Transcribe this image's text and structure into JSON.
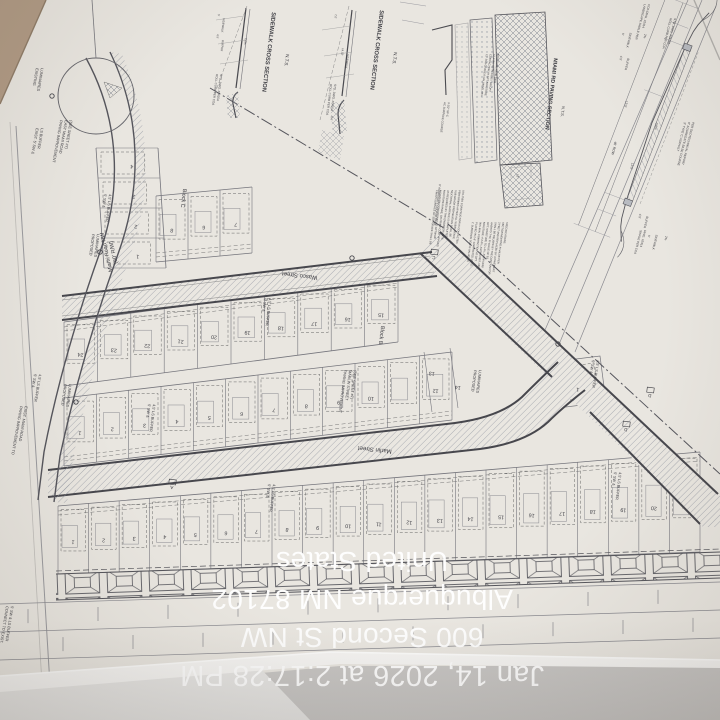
{
  "overlay": {
    "lines": [
      "Jan 14, 2026 at 2:17:28 PM",
      "600 Second St NW",
      "Albuquerque NM 87102",
      "United States"
    ],
    "color": "#ffffff"
  },
  "palette": {
    "paper": "#eae7e1",
    "table": "#b19b85",
    "ink": "#3c3c42",
    "curb": "#46464c",
    "thin": "#75757c",
    "hatch": "#9095a0",
    "shadow": "#c8c6c4",
    "fold": "#f7f6f4"
  },
  "plan": {
    "streets": [
      {
        "label": "Miami Road NW",
        "sub": "(60' R/W)"
      },
      {
        "label": "Wasco Street"
      },
      {
        "label": "Marlin Street"
      }
    ],
    "blocks": [
      {
        "name": "Block B"
      },
      {
        "name": "Block C"
      }
    ],
    "details": [
      {
        "title": "SIDEWALK CROSS SECTION",
        "scale": "N.T.S."
      },
      {
        "title": "SIDEWALK CROSS SECTION",
        "scale": "N.T.S."
      },
      {
        "title": "MIAMI RD PAVING SECTION",
        "scale": "N.T.S."
      }
    ],
    "bands": [
      {
        "name": "block-b-north-row",
        "x0": 64,
        "t0": 322,
        "b0": 386,
        "x1": 398,
        "t1": 278,
        "b1": 342,
        "f": "t",
        "nums": [
          "24",
          "23",
          "22",
          "21",
          "20",
          "19",
          "18",
          "17",
          "16",
          "15"
        ]
      },
      {
        "name": "block-b-south-row",
        "x0": 64,
        "t0": 398,
        "b0": 466,
        "x1": 452,
        "t1": 352,
        "b1": 420,
        "f": "b",
        "nums": [
          "1",
          "2",
          "3",
          "4",
          "5",
          "6",
          "7",
          "8",
          "9",
          "10",
          "",
          "12"
        ]
      },
      {
        "name": "block-a-row",
        "x0": 58,
        "t0": 506,
        "b0": 574,
        "x1": 700,
        "t1": 452,
        "b1": 552,
        "f": "t",
        "nums": [
          "1",
          "2",
          "3",
          "4",
          "5",
          "6",
          "7",
          "8",
          "9",
          "10",
          "11",
          "12",
          "13",
          "14",
          "15",
          "16",
          "17",
          "18",
          "19",
          "20",
          "21"
        ]
      },
      {
        "name": "block-c-wasco-row",
        "x0": 156,
        "t0": 196,
        "b0": 262,
        "x1": 252,
        "t1": 187,
        "b1": 253,
        "f": "b",
        "nums": [
          "8",
          "6",
          "7"
        ]
      },
      {
        "name": "block-c-miami-column",
        "col": true,
        "y0": 148,
        "l0": 96,
        "r0": 158,
        "y1": 268,
        "l1": 104,
        "r1": 166,
        "nums": [
          "4",
          "3",
          "2",
          "1"
        ]
      }
    ],
    "labels": [
      {
        "id": "label-street-miami",
        "x": 108,
        "y": 252,
        "r": 257,
        "s": 5.5,
        "a": "middle",
        "dx": 7,
        "L": [
          "Miami Road NW",
          "(60' R/W)"
        ]
      },
      {
        "id": "label-street-wasco",
        "x": 300,
        "y": 274,
        "r": 187,
        "s": 6,
        "a": "middle",
        "L": [
          "Wasco Street"
        ]
      },
      {
        "id": "label-street-marlin",
        "x": 375,
        "y": 448,
        "r": 186,
        "s": 6,
        "a": "middle",
        "L": [
          "Marlin Street"
        ]
      },
      {
        "id": "label-block-b",
        "x": 380,
        "y": 335,
        "r": 97,
        "s": 5.5,
        "a": "middle",
        "L": [
          "Block B"
        ]
      },
      {
        "id": "label-block-c",
        "x": 182,
        "y": 198,
        "r": 97,
        "s": 5.5,
        "a": "middle",
        "L": [
          "Block C"
        ]
      },
      {
        "id": "label-buffer-1",
        "x": 148,
        "y": 404,
        "r": 97,
        "s": 3.8,
        "dx": 5,
        "L": [
          "5' SW &",
          "4.5' LS BUFFER"
        ]
      },
      {
        "id": "label-buffer-2",
        "x": 264,
        "y": 298,
        "r": 97,
        "s": 3.8,
        "dx": 5,
        "L": [
          "5' SW &",
          "4.5' LS BUFFER"
        ]
      },
      {
        "id": "label-buffer-3",
        "x": 104,
        "y": 194,
        "r": 97,
        "s": 3.8,
        "dx": 5,
        "L": [
          "5' SW &",
          "4.5' LS BUFFER"
        ]
      },
      {
        "id": "label-buffer-4",
        "x": 268,
        "y": 484,
        "r": 97,
        "s": 3.8,
        "dx": 5,
        "L": [
          "5' SW &",
          "4.5' LS BUFFER"
        ]
      },
      {
        "id": "label-buffer-5",
        "x": 614,
        "y": 472,
        "r": 97,
        "s": 3.8,
        "dx": 5,
        "L": [
          "5' SW &",
          "4.5' LS BUFFER"
        ]
      },
      {
        "id": "label-buffer-6",
        "x": 592,
        "y": 360,
        "r": 100,
        "s": 3.8,
        "dx": 5,
        "L": [
          "5' SW &",
          "4.5' LS BUFFER"
        ]
      },
      {
        "id": "label-buffer-7",
        "x": 34,
        "y": 374,
        "r": 100,
        "s": 3.8,
        "dx": 5,
        "L": [
          "5' SW &",
          "4.5' LS BUFFER"
        ]
      },
      {
        "id": "label-buffer-exist",
        "x": 36,
        "y": 128,
        "r": 100,
        "s": 3.8,
        "dx": 5,
        "L": [
          "EXIST. 5' SW &",
          "LS BUFFER"
        ]
      },
      {
        "id": "note-paving-marlin",
        "x": 344,
        "y": 370,
        "r": 97,
        "s": 3.8,
        "dx": 5,
        "L": [
          "PAVING IMPROVEMENT",
          "MARLIN STREET",
          "(SEE SHEET #7)"
        ]
      },
      {
        "id": "note-paving-miami",
        "x": 20,
        "y": 406,
        "r": 100,
        "s": 3.8,
        "dx": 5,
        "L": [
          "PAVING IMPROVEMENT TO",
          "EXIST. MIAMI ROAD"
        ]
      },
      {
        "id": "note-paving-east-miami",
        "x": 60,
        "y": 120,
        "r": 100,
        "s": 3.8,
        "dx": 5,
        "L": [
          "PAVING IMPROVEMENT",
          "EAST MIAMI ROAD",
          "(SEE SHEET #7)"
        ]
      },
      {
        "id": "note-connect-exist",
        "x": 6,
        "y": 606,
        "r": 99,
        "s": 3.8,
        "dx": 5,
        "L": [
          "CONNECT TO EXIST.",
          "5' SW & LS BUFFER"
        ]
      },
      {
        "id": "note-proposed-luminaires-1",
        "x": 92,
        "y": 234,
        "r": 97,
        "s": 3.8,
        "dx": 5,
        "L": [
          "PROPOSED",
          "LUMINAIRES"
        ]
      },
      {
        "id": "note-proposed-luminaires-2",
        "x": 64,
        "y": 384,
        "r": 97,
        "s": 3.8,
        "dx": 5,
        "L": [
          "PROPOSED",
          "LUMINAIRES"
        ]
      },
      {
        "id": "note-proposed-luminaires-3",
        "x": 474,
        "y": 370,
        "r": 97,
        "s": 3.8,
        "dx": 5,
        "L": [
          "PROPOSED",
          "LUMINAIRES"
        ]
      },
      {
        "id": "note-existing-luminaires",
        "x": 36,
        "y": 68,
        "r": 100,
        "s": 3.8,
        "dx": 5,
        "L": [
          "EXISTING",
          "LUMINAIRES"
        ]
      },
      {
        "id": "lot-13",
        "x": 432,
        "y": 372,
        "r": 187,
        "s": 5.2,
        "a": "middle",
        "L": [
          "13"
        ]
      },
      {
        "id": "lot-14",
        "x": 458,
        "y": 386,
        "r": 187,
        "s": 5.2,
        "a": "middle",
        "L": [
          "14"
        ]
      },
      {
        "id": "lot-east-1",
        "x": 578,
        "y": 388,
        "r": 187,
        "s": 5.2,
        "a": "middle",
        "L": [
          "1"
        ]
      },
      {
        "id": "section-marker-a",
        "x": 172,
        "y": 486,
        "r": 187,
        "s": 4.6,
        "a": "middle",
        "m": 1,
        "L": [
          "A"
        ]
      },
      {
        "id": "section-marker-c",
        "x": 434,
        "y": 256,
        "r": 187,
        "s": 4.6,
        "a": "middle",
        "m": 1,
        "L": [
          "C"
        ]
      },
      {
        "id": "section-marker-d1",
        "x": 650,
        "y": 394,
        "r": 187,
        "s": 4.6,
        "a": "middle",
        "m": 1,
        "L": [
          "D"
        ]
      },
      {
        "id": "section-marker-d2",
        "x": 626,
        "y": 428,
        "r": 187,
        "s": 4.6,
        "a": "middle",
        "m": 1,
        "L": [
          "D"
        ]
      },
      {
        "id": "detail1-title",
        "x": 272,
        "y": 12,
        "r": 97,
        "s": 5.8,
        "b": 1,
        "L": [
          "SIDEWALK CROSS SECTION"
        ]
      },
      {
        "id": "detail1-scale",
        "x": 286,
        "y": 54,
        "r": 97,
        "s": 4.6,
        "L": [
          "N.T.S."
        ]
      },
      {
        "id": "detail2-title",
        "x": 380,
        "y": 10,
        "r": 97,
        "s": 5.8,
        "b": 1,
        "L": [
          "SIDEWALK CROSS SECTION"
        ]
      },
      {
        "id": "detail2-scale",
        "x": 394,
        "y": 52,
        "r": 97,
        "s": 4.6,
        "L": [
          "N.T.S."
        ]
      },
      {
        "id": "detail3-title",
        "x": 554,
        "y": 58,
        "r": 97,
        "s": 5.4,
        "b": 1,
        "L": [
          "MIAMI RD PAVING SECTION"
        ]
      },
      {
        "id": "detail3-scale",
        "x": 562,
        "y": 106,
        "r": 97,
        "s": 4,
        "L": [
          "N.T.S."
        ]
      },
      {
        "id": "note-roll-curb-1",
        "x": 216,
        "y": 74,
        "r": 97,
        "s": 3,
        "dx": 4.2,
        "L": [
          "ROLL CURB PER COA",
          "STD. DWG. #2415A"
        ]
      },
      {
        "id": "note-roll-curb-2",
        "x": 330,
        "y": 84,
        "r": 97,
        "s": 3,
        "dx": 4.2,
        "L": [
          "ROLL CURB PER COA",
          "STD. DWG. #2415A"
        ]
      },
      {
        "id": "note-roll-curb-3",
        "x": 670,
        "y": 18,
        "r": 104,
        "s": 3,
        "dx": 4.2,
        "L": [
          "ROLL CURB PER COA",
          "STD. DWG. #2415A"
        ]
      },
      {
        "id": "note-landscape-swale",
        "x": 644,
        "y": 4,
        "r": 104,
        "s": 3,
        "dx": 4.2,
        "L": [
          "LANDSCAPE SWALE PER",
          "COA DWG. #2414"
        ]
      },
      {
        "id": "note-asphalt",
        "x": 684,
        "y": 122,
        "r": 104,
        "s": 3,
        "dx": 4.2,
        "L": [
          "3\" TYPE 'C' ASPHALT",
          "6\" AGGREGATE BASE COURSE",
          "PER GEOTECHNICAL REPORT"
        ]
      },
      {
        "id": "note-swale-bottom",
        "x": 640,
        "y": 230,
        "r": 104,
        "s": 3,
        "dx": 4.2,
        "L": [
          "SWALE PER COA",
          "DWG. #2414"
        ]
      },
      {
        "id": "dim-row-5a",
        "x": 622,
        "y": 34,
        "r": 103,
        "s": 3,
        "a": "middle",
        "L": [
          "5'"
        ]
      },
      {
        "id": "dim-row-sidewalk-a",
        "x": 628,
        "y": 40,
        "r": 103,
        "s": 3,
        "a": "middle",
        "L": [
          "SIDEWALK"
        ]
      },
      {
        "id": "dim-row-2pct-a",
        "x": 644,
        "y": 36,
        "r": 103,
        "s": 3,
        "a": "middle",
        "L": [
          "2%"
        ]
      },
      {
        "id": "dim-row-45a",
        "x": 620,
        "y": 58,
        "r": 103,
        "s": 3,
        "a": "middle",
        "L": [
          "4.5'"
        ]
      },
      {
        "id": "dim-row-buffer-a",
        "x": 626,
        "y": 64,
        "r": 103,
        "s": 3,
        "a": "middle",
        "L": [
          "BUFFER"
        ]
      },
      {
        "id": "dim-row-135a",
        "x": 625,
        "y": 104,
        "r": 103,
        "s": 3.2,
        "a": "middle",
        "L": [
          "13.5'"
        ]
      },
      {
        "id": "dim-row-05pct",
        "x": 655,
        "y": 126,
        "r": 103,
        "s": 3.2,
        "a": "middle",
        "L": [
          "0.5%"
        ]
      },
      {
        "id": "dim-row-46row",
        "x": 613,
        "y": 148,
        "r": 103,
        "s": 3.4,
        "a": "middle",
        "L": [
          "46' ROW"
        ]
      },
      {
        "id": "dim-row-135b",
        "x": 631,
        "y": 166,
        "r": 103,
        "s": 3.2,
        "a": "middle",
        "L": [
          "13.5'"
        ]
      },
      {
        "id": "dim-row-45b",
        "x": 639,
        "y": 216,
        "r": 103,
        "s": 3,
        "a": "middle",
        "L": [
          "4.5'"
        ]
      },
      {
        "id": "dim-row-buffer-b",
        "x": 645,
        "y": 222,
        "r": 103,
        "s": 3,
        "a": "middle",
        "L": [
          "BUFFER"
        ]
      },
      {
        "id": "dim-row-5b",
        "x": 648,
        "y": 236,
        "r": 103,
        "s": 3,
        "a": "middle",
        "L": [
          "5'"
        ]
      },
      {
        "id": "dim-row-sidewalk-b",
        "x": 654,
        "y": 242,
        "r": 103,
        "s": 3,
        "a": "middle",
        "L": [
          "SIDEWALK"
        ]
      },
      {
        "id": "dim-row-2pct-b",
        "x": 665,
        "y": 238,
        "r": 103,
        "s": 3,
        "a": "middle",
        "L": [
          "2%"
        ]
      },
      {
        "id": "dim-d1-5",
        "x": 218,
        "y": 14,
        "r": 97,
        "s": 2.8,
        "L": [
          "5'"
        ]
      },
      {
        "id": "dim-d1-sidewalk",
        "x": 223,
        "y": 18,
        "r": 97,
        "s": 2.8,
        "L": [
          "SIDEWALK"
        ]
      },
      {
        "id": "dim-d1-45",
        "x": 217,
        "y": 34,
        "r": 97,
        "s": 2.8,
        "L": [
          "4.5'"
        ]
      },
      {
        "id": "dim-d1-buffer",
        "x": 222,
        "y": 40,
        "r": 97,
        "s": 2.8,
        "L": [
          "BUFFER"
        ]
      },
      {
        "id": "dim-d1-2pct",
        "x": 245,
        "y": 38,
        "r": 97,
        "s": 2.8,
        "L": [
          "2.0%"
        ]
      },
      {
        "id": "dim-d2-70",
        "x": 335,
        "y": 14,
        "r": 97,
        "s": 2.8,
        "L": [
          "7.0'"
        ]
      },
      {
        "id": "dim-d2-1452",
        "x": 342,
        "y": 48,
        "r": 97,
        "s": 2.8,
        "L": [
          "14.52'"
        ]
      },
      {
        "id": "dim-d2-sidewalk",
        "x": 347,
        "y": 54,
        "r": 97,
        "s": 2.8,
        "L": [
          "SIDEWALK"
        ]
      },
      {
        "id": "dim-d2-96",
        "x": 331,
        "y": 116,
        "r": 97,
        "s": 2.8,
        "L": [
          "9.6'"
        ]
      },
      {
        "id": "note-d3-surface",
        "x": 444,
        "y": 102,
        "r": 97,
        "s": 2.8,
        "dx": 4,
        "L": [
          "AC SURFACE COURSE",
          "3-1/2\" SP-C"
        ]
      },
      {
        "id": "note-d3-aggregate",
        "x": 439,
        "y": 184,
        "r": 97,
        "s": 2.8,
        "L": [
          "6\" AGGREGATE COURSE BASE"
        ]
      },
      {
        "id": "dim-d3-12",
        "x": 517,
        "y": 174,
        "r": 97,
        "s": 2.8,
        "L": [
          "12\""
        ]
      },
      {
        "id": "note-d3-col1",
        "x": 436,
        "y": 190,
        "r": 97,
        "s": 2.6,
        "dx": 3.8,
        "L": [
          "FINISH SURFACE OF SUB GRADE SHALL BE",
          "MOISTURE CONDITIONED AT OPTIMUM",
          "MOISTURE RANGE, OR PRIME COAT APPLIED",
          "AS REQUIRED BY THE ENGINEER UNTIL",
          "NEXT/FINAL SURFACE IS COMPLETED.",
          "SUB GRADE PREPARATION SHALL BE",
          "PERFORMED AFTER ALL SUBSURFACE",
          "UTILITIES CONSTRUCTION IS COMPLETED."
        ]
      },
      {
        "id": "note-d3-col2",
        "x": 472,
        "y": 222,
        "r": 97,
        "s": 2.6,
        "dx": 3.8,
        "L": [
          "1' SUBGRADE SOIL R-VALUE(45)",
          "PLACED IN 2-6\" COMPACTED LIFTS,",
          "95% MIN. COMPACTION AT OPT.",
          "MOISTURE +/-2.0%, ASTM D1557, OR",
          "OPT. MOISTURE TO +4%, ASTM D698",
          "AASHTO T-99, R-VALUE OF 50,",
          "SHALL BE REUSED BY THE CONTRACTOR",
          "3 FEET AND REPLACED BY A PAVEMENT",
          "SECTION MEETING R-VALUE PER",
          "SPECIFICATIONS."
        ]
      },
      {
        "id": "note-d3-col3",
        "x": 486,
        "y": 54,
        "r": 97,
        "s": 2.6,
        "dx": 3.8,
        "L": [
          "12\" SUB GRADE R-VALUE(50), 95%",
          "COMPACTION AT OPT. MOISTURE",
          "+/- 2.0%, ASTM D1557, OR OPT.",
          "MOISTURE, ASTM D698."
        ]
      }
    ]
  }
}
